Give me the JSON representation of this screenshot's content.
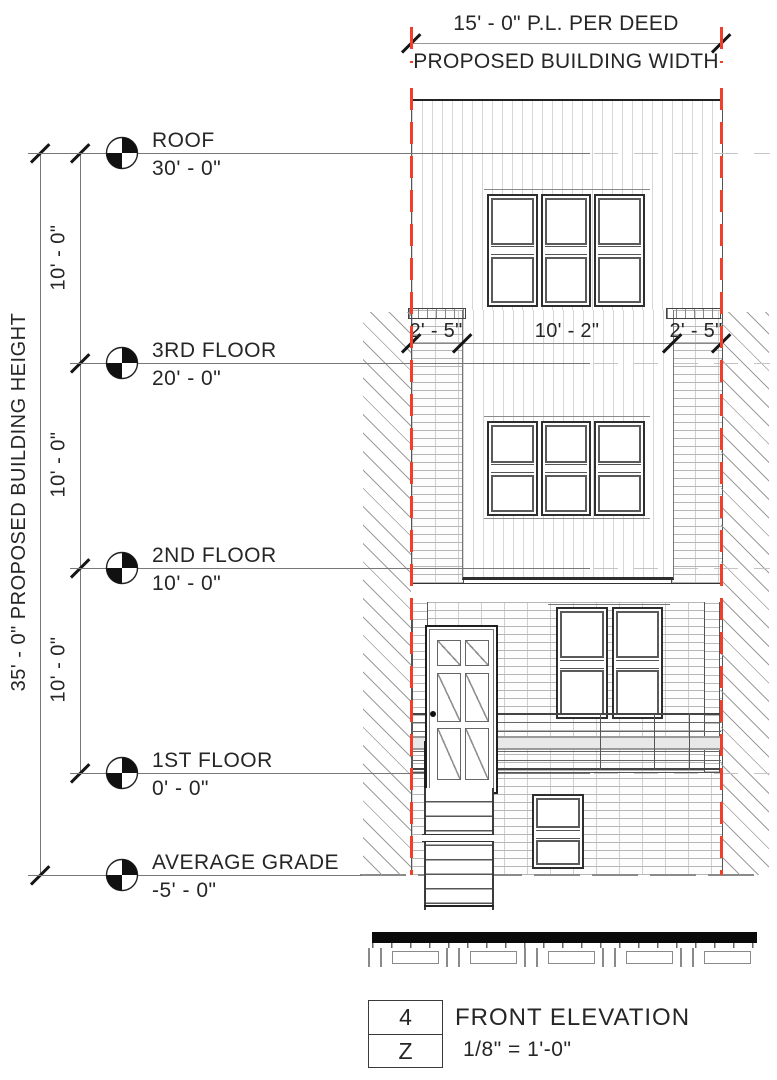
{
  "annotations": {
    "width_dim": {
      "line1": "15' - 0\" P.L. PER DEED",
      "line2": "PROPOSED BUILDING WIDTH"
    },
    "height_dim_label": "35' - 0\" PROPOSED BUILDING HEIGHT",
    "floor_spacing": [
      "10' - 0\"",
      "10' - 0\"",
      "10' - 0\""
    ],
    "facade_dims": [
      "2' - 5\"",
      "10' - 2\"",
      "2' - 5\""
    ]
  },
  "levels": [
    {
      "name": "ROOF",
      "elevation": "30' - 0\""
    },
    {
      "name": "3RD FLOOR",
      "elevation": "20' - 0\""
    },
    {
      "name": "2ND FLOOR",
      "elevation": "10' - 0\""
    },
    {
      "name": "1ST FLOOR",
      "elevation": "0' - 0\""
    },
    {
      "name": "AVERAGE GRADE",
      "elevation": "-5' - 0\""
    }
  ],
  "title_block": {
    "detail_number": "4",
    "sheet_letter": "Z",
    "title": "FRONT ELEVATION",
    "scale": "1/8\" = 1'-0\""
  },
  "colors": {
    "property_line_red": "#f0402c",
    "linework": "#3a3a3a"
  }
}
